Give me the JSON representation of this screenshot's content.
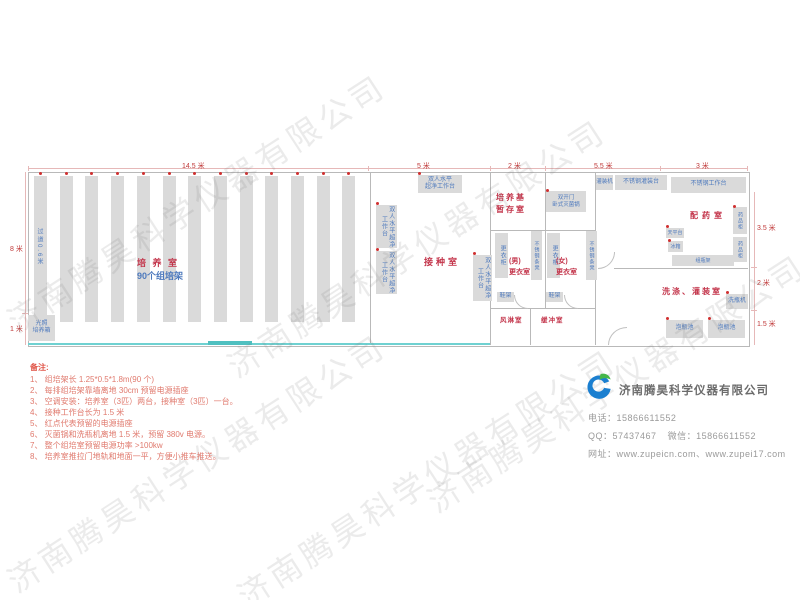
{
  "watermark": {
    "text": "济南腾昊科学仪器有限公司"
  },
  "plan": {
    "dims": {
      "top": [
        "14.5 米",
        "5 米",
        "2 米",
        "5.5 米",
        "3 米"
      ],
      "left": [
        "8 米",
        "1 米"
      ],
      "right": [
        "3.5 米",
        "2 米",
        "1.5 米"
      ]
    },
    "culture": {
      "label_red": "培 养 室",
      "label_blue": "90个组培架",
      "aisle": "过道0.6米",
      "rack_columns": 13,
      "incubator": "光照\n培养箱"
    },
    "rooms": {
      "inoculation": "接种室",
      "medium_storage": "培养基\n暂存室",
      "male_changing": "(男)\n更衣室",
      "female_changing": "(女)\n更衣室",
      "air_shower": "风淋室",
      "buffer": "缓冲室",
      "dispensing": "配药室",
      "washing": "洗涤、灌装室"
    },
    "equipment": {
      "clean_bench_2line": "双人水平\n超净工作台",
      "clean_bench_vertical": "双人水平超净工作台",
      "sterilizer": "双开门\n卧式灭菌锅",
      "wardrobe": "更衣柜",
      "steel_bench": "不锈钢条凳",
      "shoe_rack": "鞋架",
      "filling_machine": "灌装机",
      "filling_table": "不锈钢灌装台",
      "work_table": "不锈钢工作台",
      "medicine_cabinet": "药品柜",
      "balance_table": "天平台",
      "fridge": "冰箱",
      "bottle_rack": "组瓶架",
      "bottle_washer": "洗瓶机",
      "soak_pool": "泡瓶池"
    }
  },
  "notes": {
    "title": "备注:",
    "items": [
      "1、 组培架长 1.25*0.5*1.8m(90 个)",
      "2、 每排组培架靠墙离地 30cm 预留电源插座",
      "3、 空调安装：培养室（3匹）两台，接种室（3匹）一台。",
      "4、 接种工作台长为 1.5 米",
      "5、 红点代表预留的电源插座",
      "6、 灭菌锅和洗瓶机离地 1.5 米，预留 380v 电源。",
      "7、 整个组培室预留电源功率 >100kw",
      "8、 培养室推拉门地轨和地面一平，方便小推车推送。"
    ]
  },
  "company": {
    "name": "济南腾昊科学仪器有限公司",
    "phone_label": "电话：",
    "phone": "15866611552",
    "qq_label": "QQ：",
    "qq": "57437467",
    "wechat_label": "微信：",
    "wechat": "15866611552",
    "web_label": "网址：",
    "web": "www.zupeicn.com、www.zupei17.com"
  }
}
